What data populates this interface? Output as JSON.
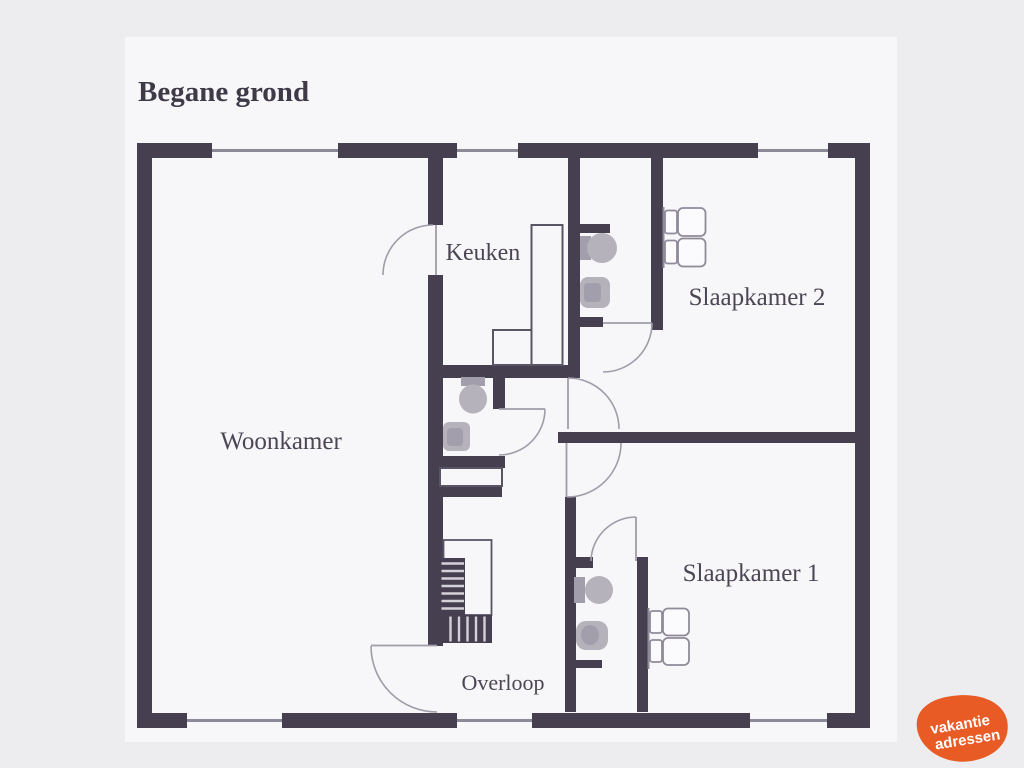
{
  "title": "Begane grond",
  "rooms": [
    {
      "id": "woonkamer",
      "label": "Woonkamer"
    },
    {
      "id": "keuken",
      "label": "Keuken"
    },
    {
      "id": "slaapkamer2",
      "label": "Slaapkamer 2"
    },
    {
      "id": "slaapkamer1",
      "label": "Slaapkamer 1"
    },
    {
      "id": "overloop",
      "label": "Overloop"
    }
  ],
  "logo": {
    "line1": "vakantie",
    "line2": "adressen"
  },
  "colors": {
    "background": "#edecef",
    "canvas": "#f7f6f8",
    "wall": "#453f4f",
    "window_line": "#8d8a97",
    "door_line": "#a09daa",
    "outline": "#5a5565",
    "fixture": "#b6b2bc",
    "fixture_dark": "#a29eab",
    "stripe": "#d4d2d9",
    "bed_outline": "#8f8b99",
    "text": "#4b4654",
    "title_text": "#3e3a48",
    "logo": "#e95b25",
    "logo_text": "#ffffff"
  }
}
